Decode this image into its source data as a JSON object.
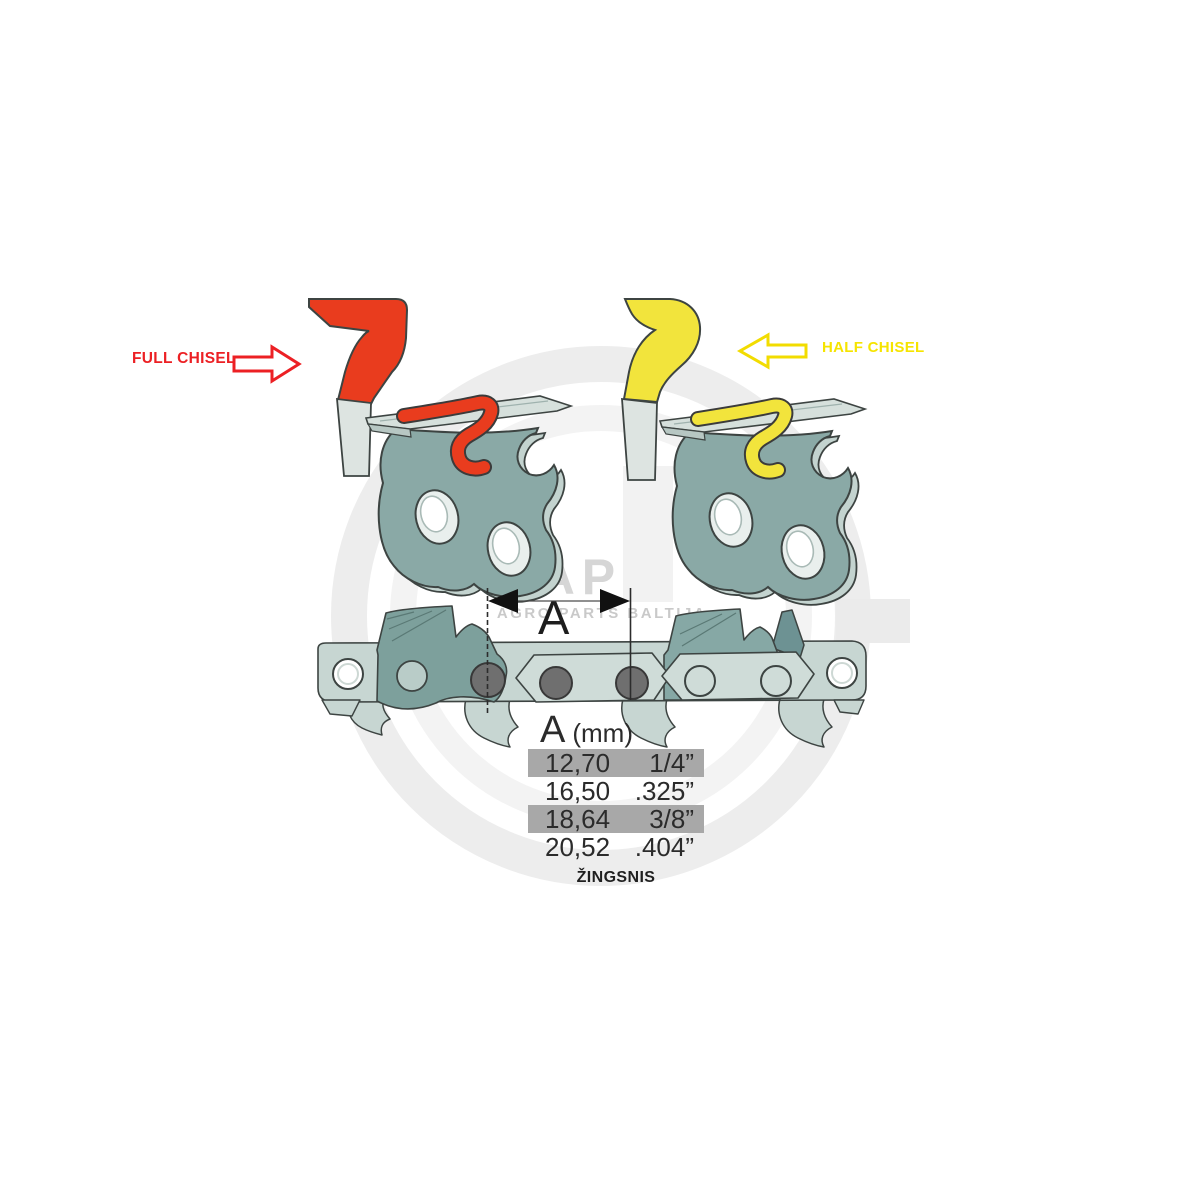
{
  "annotations": {
    "full_chisel": {
      "label": "FULL CHISEL",
      "color": "#ec2024"
    },
    "half_chisel": {
      "label": "HALF CHISEL",
      "color": "#f6e400"
    }
  },
  "dimension": {
    "letter": "A"
  },
  "pitch_table": {
    "header": {
      "letter": "A",
      "unit": "(mm)"
    },
    "rows": [
      {
        "mm": "12,70",
        "inch": "1/4”",
        "highlighted": true
      },
      {
        "mm": "16,50",
        "inch": ".325”",
        "highlighted": false
      },
      {
        "mm": "18,64",
        "inch": "3/8”",
        "highlighted": true
      },
      {
        "mm": "20,52",
        "inch": ".404”",
        "highlighted": false
      }
    ],
    "caption": "ŽINGSNIS",
    "highlight_color": "#a8a8a8"
  },
  "watermark": {
    "logo": "APB",
    "tagline": "AGRO PARTS BALTIJA"
  },
  "colors": {
    "full_chisel_red": "#e93c1e",
    "half_chisel_yellow": "#f2e43c",
    "steel_teal_body": "#8aa9a6",
    "chain_link_dark": "#7da09c",
    "chain_strap_light": "#c7d6d2",
    "outline": "#3d4442",
    "rivet_dark": "#6f6f6f"
  }
}
